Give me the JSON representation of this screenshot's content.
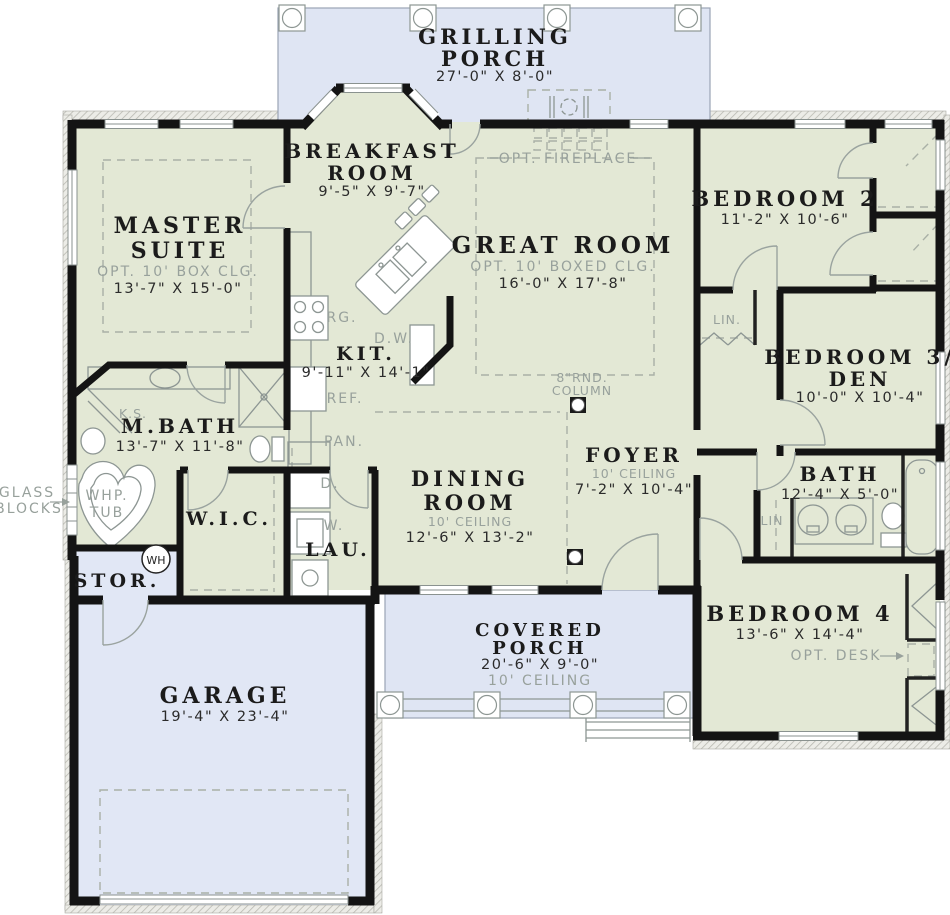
{
  "plan": {
    "grilling": {
      "l1": "GRILLING",
      "l2": "PORCH",
      "dims": "27'-0\" X 8'-0\""
    },
    "breakfast": {
      "l1": "BREAKFAST",
      "l2": "ROOM",
      "dims": "9'-5\" X 9'-7\""
    },
    "master": {
      "l1": "MASTER",
      "l2": "SUITE",
      "note": "OPT. 10' BOX CLG.",
      "dims": "13'-7\" X 15'-0\""
    },
    "great": {
      "l1": "GREAT ROOM",
      "note": "OPT. 10' BOXED CLG.",
      "dims": "16'-0\" X 17'-8\""
    },
    "bedroom2": {
      "l1": "BEDROOM 2",
      "dims": "11'-2\" X 10'-6\""
    },
    "bedroom3": {
      "l1": "BEDROOM 3/",
      "l2": "DEN",
      "dims": "10'-0\" X 10'-4\""
    },
    "kitchen": {
      "l1": "KIT.",
      "dims": "9'-11\" X 14'-1\""
    },
    "mbath": {
      "l1": "M.BATH",
      "dims": "13'-7\" X 11'-8\""
    },
    "foyer": {
      "l1": "FOYER",
      "note": "10' CEILING",
      "dims": "7'-2\" X 10'-4\""
    },
    "bath": {
      "l1": "BATH",
      "dims": "12'-4\" X 5'-0\""
    },
    "dining": {
      "l1": "DINING",
      "l2": "ROOM",
      "note": "10' CEILING",
      "dims": "12'-6\" X 13'-2\""
    },
    "wic": {
      "l1": "W.I.C."
    },
    "lau": {
      "l1": "LAU."
    },
    "stor": {
      "l1": "STOR."
    },
    "bedroom4": {
      "l1": "BEDROOM 4",
      "dims": "13'-6\" X 14'-4\""
    },
    "porch": {
      "l1": "COVERED",
      "l2": "PORCH",
      "dims": "20'-6\" X 9'-0\"",
      "note": "10' CEILING"
    },
    "garage": {
      "l1": "GARAGE",
      "dims": "19'-4\" X 23'-4\""
    },
    "ann": {
      "fireplace": "OPT. FIREPLACE",
      "rg": "RG.",
      "dw": "D.W.",
      "ref": "REF.",
      "pan": "PAN.",
      "ks": "K.S.",
      "whp1": "WHP.",
      "whp2": "TUB",
      "glass1": "GLASS",
      "glass2": "BLOCKS",
      "col1": "8\"RND.",
      "col2": "COLUMN",
      "lin1": "LIN.",
      "lin2": "LIN",
      "wh": "WH",
      "d": "D.",
      "w": "W.",
      "desk": "OPT. DESK"
    },
    "colors": {
      "room": "#e3e8d5",
      "porchBlue": "#dfe5f3",
      "garageBlue": "#e1e7f5",
      "wall": "#141414",
      "gray": "#98a19c"
    }
  }
}
